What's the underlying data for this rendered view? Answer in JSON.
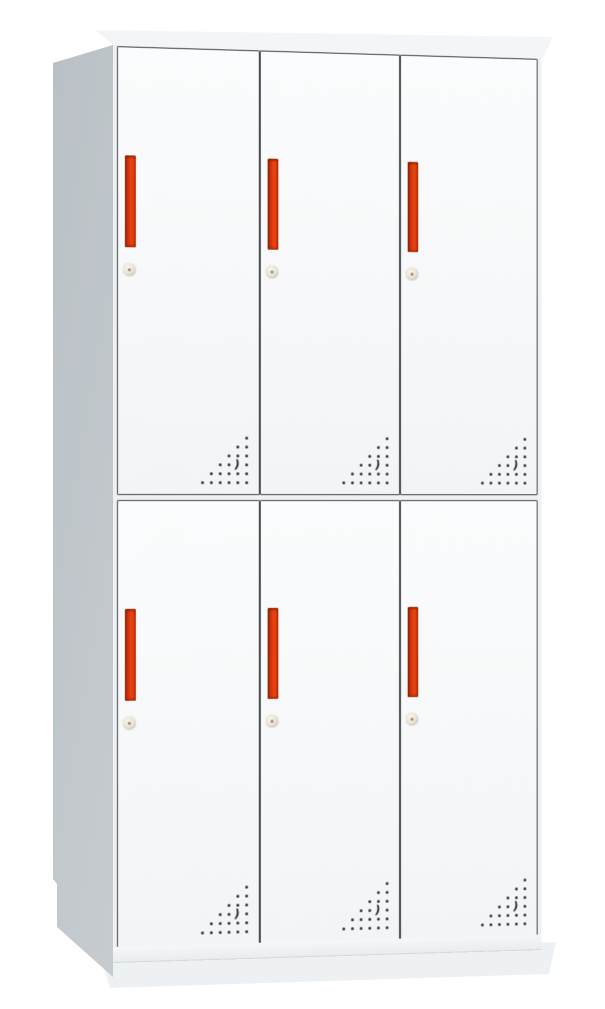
{
  "scene": {
    "description": "Product photo of a light-colored steel office locker cabinet with six doors (2 rows x 3 columns) on a plain white background, viewed from the front-left with slight perspective.",
    "object": "6-door metal locker / storage cabinet",
    "background": "plain white studio backdrop",
    "visible_text": ""
  },
  "colors": {
    "background": "#ffffff",
    "top_face": "#f3f5f6",
    "side_panel": "#c5cbcf",
    "side_panel_dark": "#b7bec3",
    "front_margin": "#eef1f3",
    "door_face": "#f7f9fa",
    "door_face_bottom": "#f2f4f6",
    "frame_line": "#3e4347",
    "base_top": "#f5f7f8",
    "base_bottom": "#e9edef",
    "handle_dark": "#8e1d05",
    "handle_main": "#e8430f",
    "handle_edge": "#b72e08",
    "lock_face": "#ece6d6",
    "lock_ring": "#c9c4b2",
    "keyhole": "#8c8578",
    "vent_dot": "#2e3236",
    "shadow": "#e9edf0"
  },
  "cabinet": {
    "rows": 2,
    "columns": 3,
    "door_count": 6,
    "doors": [
      {
        "position": "top-left"
      },
      {
        "position": "top-center"
      },
      {
        "position": "top-right"
      },
      {
        "position": "bottom-left"
      },
      {
        "position": "bottom-center"
      },
      {
        "position": "bottom-right"
      }
    ],
    "door_features": {
      "handle": "vertical recessed red pull handle near left edge",
      "lock": "small round cam key lock below handle",
      "vents": "triangular perforation dot pattern in bottom-right corner"
    },
    "vent_pattern": {
      "grid_cols": 6,
      "grid_rows": 6,
      "spacing_px": 9,
      "dot_size_px": 3,
      "rows": [
        [
          5
        ],
        [
          4,
          5
        ],
        [
          3,
          4,
          5
        ],
        [
          2,
          3,
          5
        ],
        [
          1,
          2,
          3,
          4,
          5
        ],
        [
          0,
          1,
          2,
          3,
          4,
          5
        ]
      ],
      "crescent": {
        "row": 3,
        "col": 4,
        "glyph": ")"
      }
    }
  }
}
